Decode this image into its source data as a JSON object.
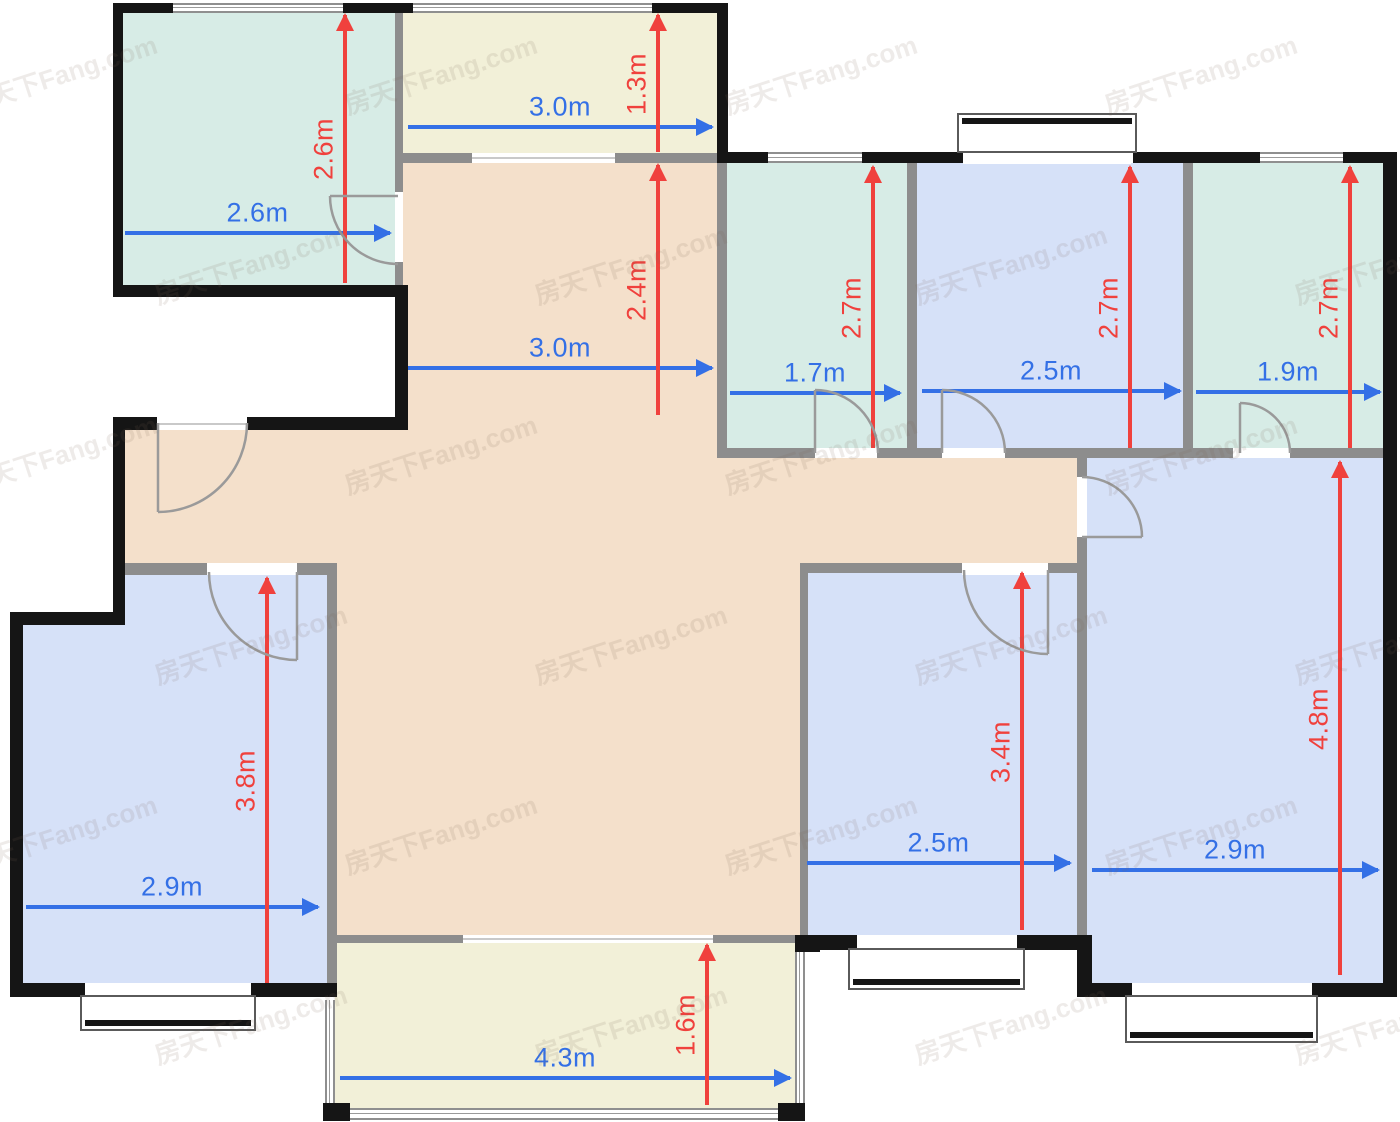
{
  "canvas": {
    "width": 1400,
    "height": 1122,
    "background": "#ffffff"
  },
  "palette": {
    "teal": "#d7ece6",
    "cream": "#f2f0d8",
    "peach": "#f4e0cb",
    "blue": "#d6e1f8",
    "wall_black": "#151515",
    "wall_gray": "#8d8d8d",
    "dim_blue": "#3470e6",
    "dim_red": "#f0413d",
    "watermark_color": "rgba(125,100,85,0.13)"
  },
  "watermark": {
    "text": "房天下Fang.com",
    "angle_deg": -18
  },
  "rooms": [
    {
      "id": "kitchen-top-left",
      "color": "teal",
      "width_m": 2.6,
      "depth_m": 2.6,
      "rects": [
        [
          123,
          13,
          272,
          272
        ]
      ]
    },
    {
      "id": "balcony-north",
      "color": "cream",
      "width_m": 3.0,
      "depth_m": 1.3,
      "rects": [
        [
          403,
          13,
          314,
          140
        ]
      ]
    },
    {
      "id": "living-dining-hall",
      "color": "peach",
      "width_m": 3.0,
      "depth_m": 2.4,
      "rects": [
        [
          403,
          163,
          314,
          270
        ],
        [
          125,
          430,
          592,
          140
        ],
        [
          717,
          458,
          360,
          112
        ],
        [
          337,
          570,
          463,
          365
        ]
      ]
    },
    {
      "id": "bathroom-1",
      "color": "teal",
      "width_m": 1.7,
      "depth_m": 2.7,
      "rects": [
        [
          727,
          163,
          180,
          285
        ]
      ]
    },
    {
      "id": "bedroom-north",
      "color": "blue",
      "width_m": 2.5,
      "depth_m": 2.7,
      "rects": [
        [
          917,
          163,
          266,
          285
        ]
      ]
    },
    {
      "id": "bathroom-2",
      "color": "teal",
      "width_m": 1.9,
      "depth_m": 2.7,
      "rects": [
        [
          1193,
          163,
          190,
          285
        ]
      ]
    },
    {
      "id": "bedroom-east",
      "color": "blue",
      "width_m": 2.9,
      "depth_m": 4.8,
      "rects": [
        [
          1087,
          458,
          296,
          525
        ]
      ]
    },
    {
      "id": "bedroom-south",
      "color": "blue",
      "width_m": 2.5,
      "depth_m": 3.4,
      "rects": [
        [
          805,
          570,
          272,
          365
        ]
      ]
    },
    {
      "id": "bedroom-west",
      "color": "blue",
      "width_m": 2.9,
      "depth_m": 3.8,
      "rects": [
        [
          125,
          570,
          202,
          413
        ],
        [
          23,
          620,
          104,
          363
        ]
      ]
    },
    {
      "id": "balcony-south",
      "color": "cream",
      "width_m": 4.3,
      "depth_m": 1.6,
      "rects": [
        [
          335,
          943,
          460,
          165
        ]
      ]
    }
  ],
  "walls": {
    "gray": [
      [
        395,
        13,
        8,
        272
      ],
      [
        403,
        153,
        314,
        10
      ],
      [
        717,
        163,
        10,
        295
      ],
      [
        907,
        163,
        10,
        285
      ],
      [
        1183,
        163,
        10,
        285
      ],
      [
        717,
        448,
        680,
        10
      ],
      [
        1077,
        458,
        10,
        525
      ],
      [
        125,
        563,
        212,
        12
      ],
      [
        327,
        563,
        10,
        425
      ],
      [
        800,
        563,
        277,
        10
      ],
      [
        800,
        563,
        8,
        372
      ],
      [
        333,
        935,
        472,
        8
      ]
    ],
    "black": [
      [
        113,
        3,
        60,
        10
      ],
      [
        343,
        3,
        70,
        10
      ],
      [
        652,
        3,
        76,
        10
      ],
      [
        113,
        3,
        10,
        294
      ],
      [
        113,
        285,
        295,
        12
      ],
      [
        395,
        297,
        13,
        133
      ],
      [
        717,
        3,
        11,
        160
      ],
      [
        728,
        152,
        40,
        11
      ],
      [
        862,
        152,
        101,
        11
      ],
      [
        1133,
        152,
        127,
        11
      ],
      [
        1343,
        152,
        54,
        11
      ],
      [
        1383,
        152,
        14,
        845
      ],
      [
        113,
        417,
        290,
        13
      ],
      [
        113,
        417,
        12,
        203
      ],
      [
        10,
        612,
        115,
        13
      ],
      [
        10,
        612,
        13,
        385
      ],
      [
        10,
        983,
        327,
        14
      ],
      [
        800,
        935,
        292,
        15
      ],
      [
        1077,
        935,
        15,
        62
      ],
      [
        1077,
        983,
        320,
        14
      ]
    ],
    "posts": [
      [
        323,
        1103,
        27,
        18
      ],
      [
        778,
        1103,
        27,
        18
      ],
      [
        795,
        935,
        25,
        17
      ]
    ]
  },
  "windows": [
    {
      "rect": [
        173,
        3,
        170,
        10
      ],
      "dir": "h"
    },
    {
      "rect": [
        413,
        3,
        239,
        10
      ],
      "dir": "h"
    },
    {
      "rect": [
        768,
        152,
        94,
        11
      ],
      "dir": "h"
    },
    {
      "rect": [
        1260,
        152,
        83,
        11
      ],
      "dir": "h"
    },
    {
      "rect": [
        325,
        1000,
        10,
        108
      ],
      "dir": "v"
    },
    {
      "rect": [
        795,
        952,
        10,
        151
      ],
      "dir": "v"
    },
    {
      "rect": [
        350,
        1108,
        428,
        12
      ],
      "dir": "h"
    }
  ],
  "bays": [
    {
      "rect": [
        957,
        113,
        180,
        40
      ],
      "stripe": "top",
      "opening": [
        963,
        152,
        168,
        12
      ]
    },
    {
      "rect": [
        80,
        995,
        176,
        36
      ],
      "stripe": "bottom",
      "opening": [
        85,
        983,
        166,
        15
      ]
    },
    {
      "rect": [
        848,
        948,
        177,
        42
      ],
      "stripe": "bottom",
      "opening": [
        857,
        935,
        160,
        16
      ]
    },
    {
      "rect": [
        1125,
        995,
        193,
        48
      ],
      "stripe": "bottom",
      "opening": [
        1132,
        983,
        180,
        15
      ]
    }
  ],
  "openings": [
    {
      "rect": [
        157,
        417,
        90,
        13
      ],
      "line": true
    },
    {
      "rect": [
        395,
        192,
        8,
        70
      ],
      "line": false
    },
    {
      "rect": [
        472,
        153,
        143,
        10
      ],
      "line": true
    },
    {
      "rect": [
        815,
        448,
        62,
        10
      ],
      "line": false
    },
    {
      "rect": [
        942,
        448,
        63,
        10
      ],
      "line": false
    },
    {
      "rect": [
        1233,
        448,
        57,
        10
      ],
      "line": false
    },
    {
      "rect": [
        1077,
        477,
        10,
        60
      ],
      "line": false
    },
    {
      "rect": [
        962,
        563,
        86,
        12
      ],
      "line": false
    },
    {
      "rect": [
        207,
        563,
        90,
        12
      ],
      "line": false
    },
    {
      "rect": [
        463,
        935,
        250,
        8
      ],
      "line": true
    }
  ],
  "doors": [
    {
      "id": "kitchen",
      "leaf": "M398,196 L330,196",
      "arc": "M330,196 A68,68 0 0 0 398,264"
    },
    {
      "id": "entry",
      "leaf": "M158,423 L158,512",
      "arc": "M158,512 A89,89 0 0 0 247,423"
    },
    {
      "id": "bathroom-1",
      "leaf": "M815,453 L815,390",
      "arc": "M815,390 A63,63 0 0 1 878,453"
    },
    {
      "id": "bedroom-north",
      "leaf": "M942,453 L942,390",
      "arc": "M942,390 A63,63 0 0 1 1005,453"
    },
    {
      "id": "bathroom-2",
      "leaf": "M1240,453 L1240,403",
      "arc": "M1240,403 A50,50 0 0 1 1290,453"
    },
    {
      "id": "bedroom-east",
      "leaf": "M1082,537 L1142,537",
      "arc": "M1142,537 A60,60 0 0 0 1082,477"
    },
    {
      "id": "bedroom-south",
      "leaf": "M1048,570 L1048,654",
      "arc": "M1048,654 A84,84 0 0 1 964,570"
    },
    {
      "id": "bedroom-west",
      "leaf": "M297,572 L297,660",
      "arc": "M297,660 A88,88 0 0 1 209,572"
    }
  ],
  "dimensions": {
    "horizontal": [
      {
        "label": "2.6m",
        "x1": 125,
        "x2": 390,
        "y": 233
      },
      {
        "label": "3.0m",
        "x1": 408,
        "x2": 712,
        "y": 127
      },
      {
        "label": "3.0m",
        "x1": 408,
        "x2": 712,
        "y": 368
      },
      {
        "label": "1.7m",
        "x1": 730,
        "x2": 900,
        "y": 393
      },
      {
        "label": "2.5m",
        "x1": 922,
        "x2": 1180,
        "y": 391
      },
      {
        "label": "1.9m",
        "x1": 1196,
        "x2": 1380,
        "y": 392
      },
      {
        "label": "2.9m",
        "x1": 26,
        "x2": 318,
        "y": 907
      },
      {
        "label": "2.5m",
        "x1": 807,
        "x2": 1070,
        "y": 863
      },
      {
        "label": "2.9m",
        "x1": 1092,
        "x2": 1378,
        "y": 870
      },
      {
        "label": "4.3m",
        "x1": 340,
        "x2": 790,
        "y": 1078
      }
    ],
    "vertical": [
      {
        "label": "2.6m",
        "x": 345,
        "y1": 15,
        "y2": 283
      },
      {
        "label": "1.3m",
        "x": 658,
        "y1": 15,
        "y2": 152
      },
      {
        "label": "2.4m",
        "x": 658,
        "y1": 165,
        "y2": 415
      },
      {
        "label": "2.7m",
        "x": 873,
        "y1": 167,
        "y2": 448
      },
      {
        "label": "2.7m",
        "x": 1130,
        "y1": 167,
        "y2": 448
      },
      {
        "label": "2.7m",
        "x": 1350,
        "y1": 167,
        "y2": 448
      },
      {
        "label": "3.8m",
        "x": 267,
        "y1": 578,
        "y2": 983
      },
      {
        "label": "3.4m",
        "x": 1022,
        "y1": 573,
        "y2": 930
      },
      {
        "label": "4.8m",
        "x": 1340,
        "y1": 462,
        "y2": 975
      },
      {
        "label": "1.6m",
        "x": 707,
        "y1": 945,
        "y2": 1105
      }
    ]
  }
}
